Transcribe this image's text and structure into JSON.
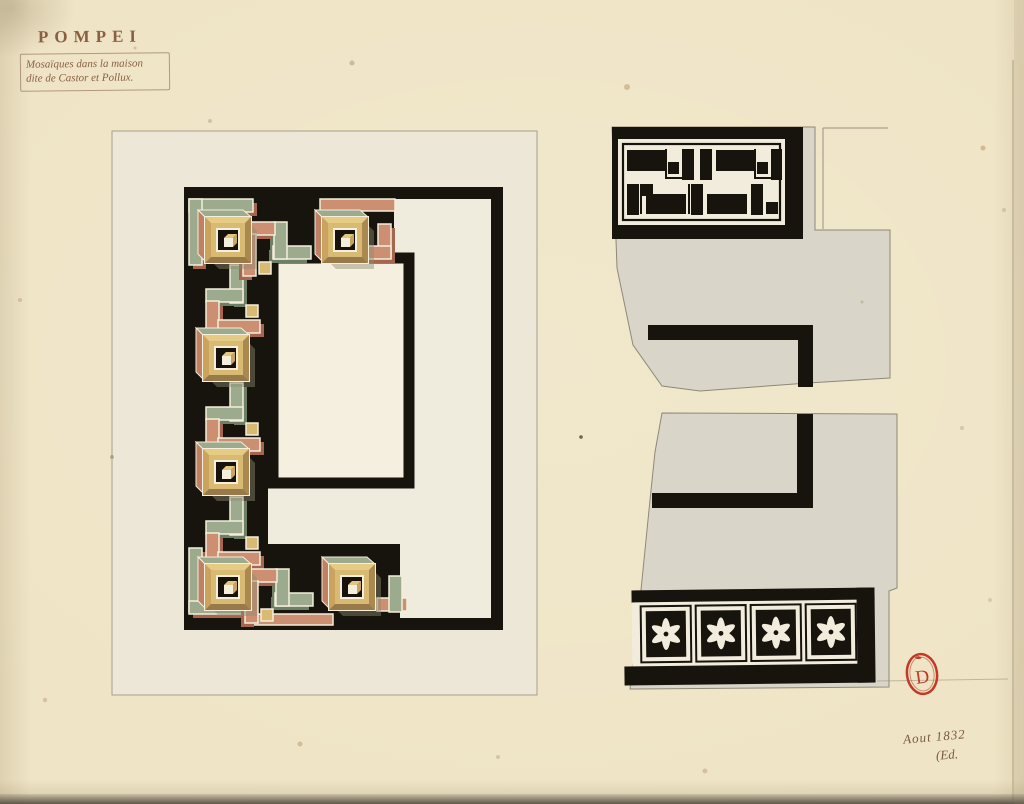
{
  "header": {
    "title": "POMPEI",
    "caption_line1": "Mosaïques dans la maison",
    "caption_line2": "dite de Castor et Pollux."
  },
  "annotations": {
    "date_note": "Aout 1832",
    "monogram": "(Ed.",
    "stamp_letter": "D"
  },
  "artwork": {
    "left_panel": {
      "subject": "perspective-meander-mosaic-border",
      "coffer_count": 6
    },
    "right_fragments": {
      "key_meander_band": "black-white-key-fret-band",
      "panel_outline": "black-corner-bands-on-two-torn-fragments",
      "rosette_band_count": 4
    }
  },
  "palette": {
    "paper": "#efe4c5",
    "sheet": "#ece8d8",
    "fragment_grey": "#d9d5c8",
    "ink_black": "#17130d",
    "salmon": "#cd8f72",
    "salmon_dark": "#a5654e",
    "green": "#9cab8e",
    "green_dark": "#6f7f66",
    "tan": "#d9ba72",
    "tan_dark": "#a9894f",
    "cream": "#f4eedb",
    "stamp_red": "#c23a27",
    "ink_brown": "#8a5f43"
  }
}
